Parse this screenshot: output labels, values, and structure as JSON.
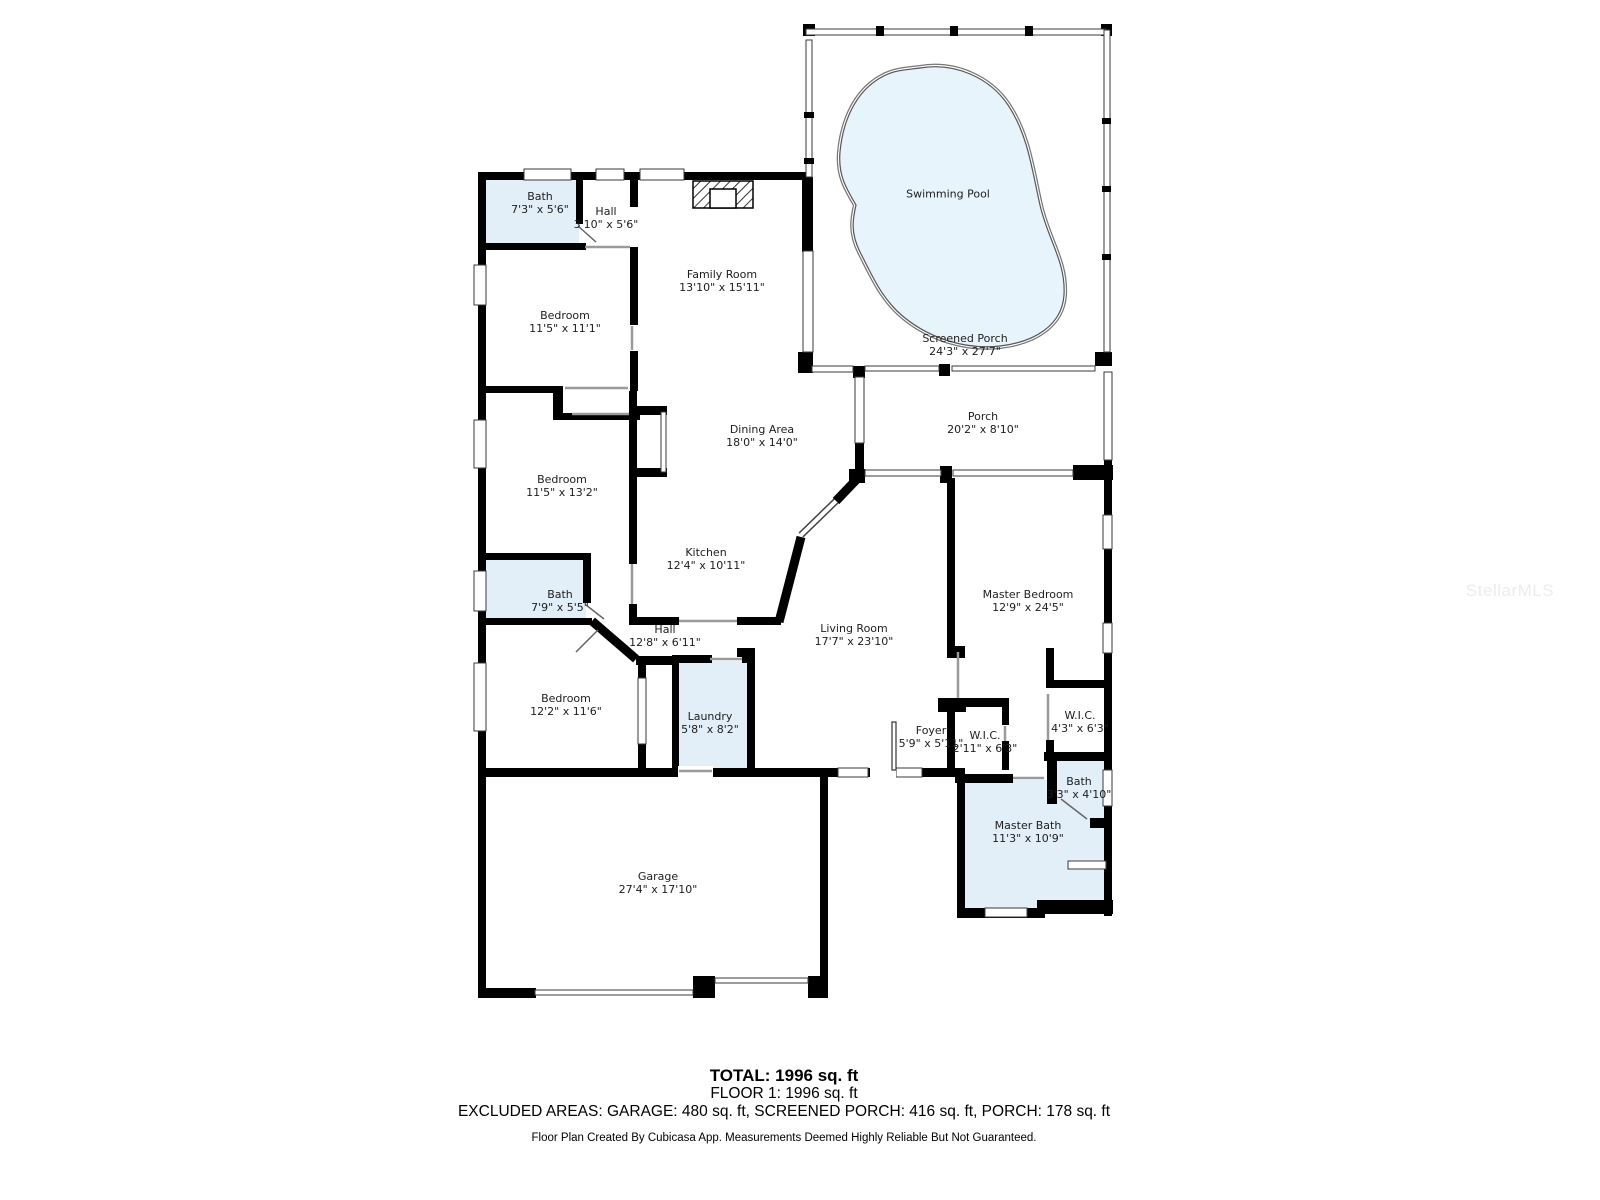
{
  "watermark": "StellarMLS",
  "colors": {
    "wall": "#000000",
    "wet_room_fill": "#e2eff9",
    "pool_fill": "#e8f4fb",
    "label_text": "#1d1d1d"
  },
  "rooms": [
    {
      "name": "Bath",
      "dims": "7'3\" x 5'6\""
    },
    {
      "name": "Hall",
      "dims": "3'10\" x 5'6\""
    },
    {
      "name": "Bedroom",
      "dims": "11'5\" x 11'1\""
    },
    {
      "name": "Family Room",
      "dims": "13'10\" x 15'11\""
    },
    {
      "name": "Swimming Pool",
      "dims": ""
    },
    {
      "name": "Screened Porch",
      "dims": "24'3\" x 27'7\""
    },
    {
      "name": "Dining Area",
      "dims": "18'0\" x 14'0\""
    },
    {
      "name": "Bedroom",
      "dims": "11'5\" x 13'2\""
    },
    {
      "name": "Kitchen",
      "dims": "12'4\" x 10'11\""
    },
    {
      "name": "Bath",
      "dims": "7'9\" x 5'5\""
    },
    {
      "name": "Hall",
      "dims": "12'8\" x 6'11\""
    },
    {
      "name": "Porch",
      "dims": "20'2\" x 8'10\""
    },
    {
      "name": "Living Room",
      "dims": "17'7\" x 23'10\""
    },
    {
      "name": "Master Bedroom",
      "dims": "12'9\" x 24'5\""
    },
    {
      "name": "Bedroom",
      "dims": "12'2\" x 11'6\""
    },
    {
      "name": "Laundry",
      "dims": "5'8\" x 8'2\""
    },
    {
      "name": "Foyer",
      "dims": "5'9\" x 5'11\""
    },
    {
      "name": "W.I.C.",
      "dims": "2'11\" x 6'3\""
    },
    {
      "name": "W.I.C.",
      "dims": "4'3\" x 6'3\""
    },
    {
      "name": "Bath",
      "dims": "3'3\" x 4'10\""
    },
    {
      "name": "Master Bath",
      "dims": "11'3\" x 10'9\""
    },
    {
      "name": "Garage",
      "dims": "27'4\" x 17'10\""
    }
  ],
  "summary": {
    "total": "TOTAL: 1996 sq. ft",
    "floor": "FLOOR 1: 1996 sq. ft",
    "excluded": "EXCLUDED AREAS: GARAGE: 480 sq. ft, SCREENED PORCH: 416 sq. ft, PORCH: 178 sq. ft",
    "disclaimer": "Floor Plan Created By Cubicasa App. Measurements Deemed Highly Reliable But Not Guaranteed."
  }
}
